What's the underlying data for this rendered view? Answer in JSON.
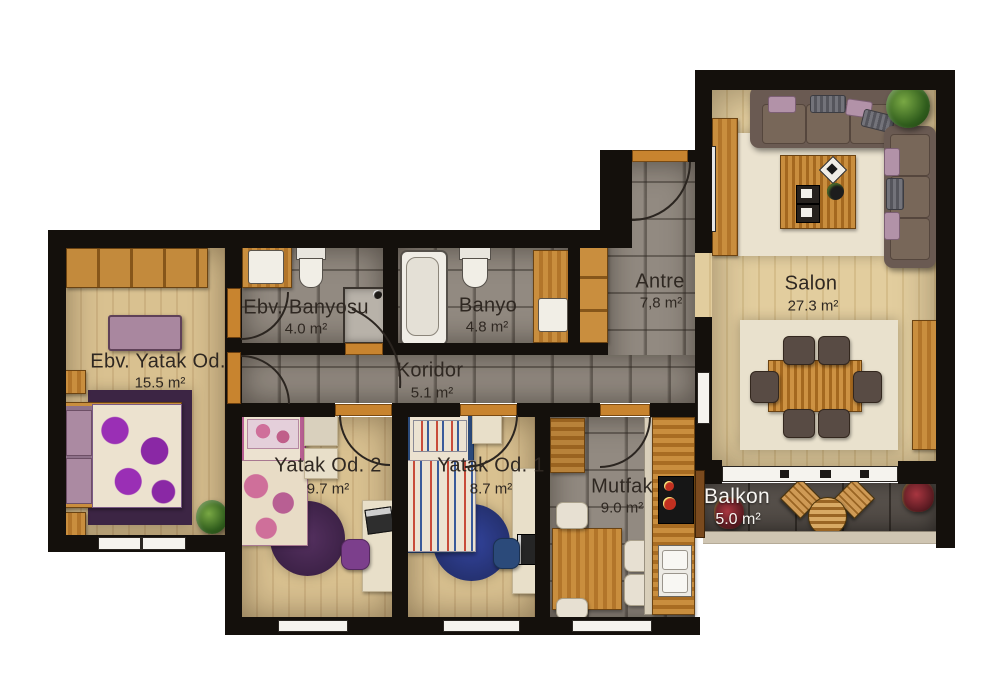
{
  "plan_title": "Apartment floor plan",
  "rooms": [
    {
      "id": "ebv-yatak-odasi",
      "name": "Ebv. Yatak Od.",
      "area": "15.5 m²"
    },
    {
      "id": "ebv-banyosu",
      "name": "Ebv. Banyosu",
      "area": "4.0 m²"
    },
    {
      "id": "banyo",
      "name": "Banyo",
      "area": "4.8 m²"
    },
    {
      "id": "antre",
      "name": "Antre",
      "area": "7,8 m²"
    },
    {
      "id": "koridor",
      "name": "Koridor",
      "area": "5.1 m²"
    },
    {
      "id": "salon",
      "name": "Salon",
      "area": "27.3 m²"
    },
    {
      "id": "yatak-odasi-2",
      "name": "Yatak Od. 2",
      "area": "9.7 m²"
    },
    {
      "id": "yatak-odasi-1",
      "name": "Yatak Od. 1",
      "area": "8.7 m²"
    },
    {
      "id": "mutfak",
      "name": "Mutfak",
      "area": "9.0 m²"
    },
    {
      "id": "balkon",
      "name": "Balkon",
      "area": "5.0 m²"
    }
  ],
  "colors": {
    "wall": "#14100c",
    "wood_floor": "#d9c190",
    "tile_floor": "#928a81",
    "balcony_floor": "#57504a",
    "furniture_wood": "#c08436",
    "threshold_orange": "#c8842f",
    "sofa_brown": "#6a5a52",
    "rug_cream": "#eae2cf",
    "accent_purple": "#7c3f8c",
    "accent_pink": "#b85f93",
    "accent_blue": "#2b4a7a",
    "label_dark": "#2f2822",
    "label_light": "#f7f5f1"
  }
}
